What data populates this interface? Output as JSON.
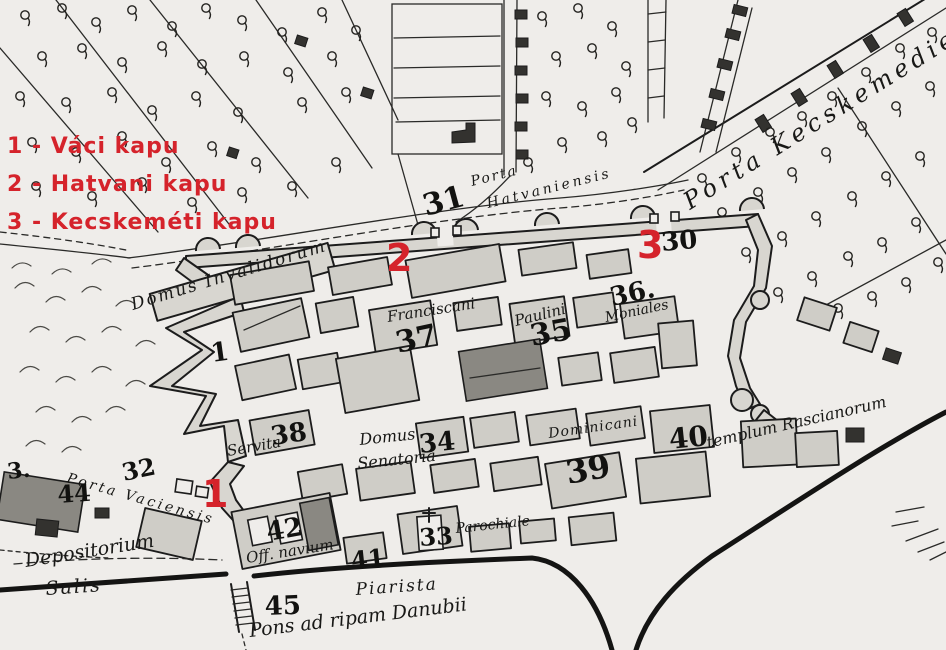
{
  "title": "Historical hand-drawn map of Pest with numbered city gates",
  "colors": {
    "paper": "#efedea",
    "ink": "#1c1c1c",
    "block_shade": "#d8d6d0",
    "dark_building": "#8a8882",
    "annotation_red": "#d5232b"
  },
  "legend": {
    "items": [
      {
        "text": "1 - Váci kapu"
      },
      {
        "text": "2 - Hatvani kapu"
      },
      {
        "text": "3 - Kecskeméti kapu"
      }
    ]
  },
  "gate_markers": {
    "m1": "1",
    "m2": "2",
    "m3": "3"
  },
  "map_labels": {
    "porta_hatvaniensis_line1": "Porta",
    "porta_hatvaniensis_line2": "Hatvaniensis",
    "porta_kecskemetiensis": "Porta Kecskemedien",
    "porta_vaciensis": "Porta Vaciensis",
    "domus_invalidorum": "Domus Invalidorum",
    "franciscani": "Franciscani",
    "paulini": "Paulini",
    "moniales": "Moniales",
    "dominicani": "Dominicani",
    "templum_rascianorum": "templum Rascianorum",
    "domus_senatoria_line1": "Domus",
    "domus_senatoria_line2": "Senatoria",
    "servita": "Servita",
    "parochiale": "Parochiale",
    "off_navium": "Off. navium",
    "depositorium": "Depositorium",
    "salis": "Salis",
    "piarista": "Piarista",
    "pons_ad_ripam": "Pons ad ripam Danubii"
  },
  "numbers": {
    "n1_fort": "1",
    "n30": "30",
    "n31": "31",
    "n32": "32",
    "n33": "33",
    "n34": "34",
    "n35": "35",
    "n36": "36.",
    "n37": "37",
    "n38": "38",
    "n39": "39",
    "n40": "40",
    "n41": "41",
    "n42": "42",
    "n44": "44",
    "n45": "45",
    "edge3": "3."
  }
}
